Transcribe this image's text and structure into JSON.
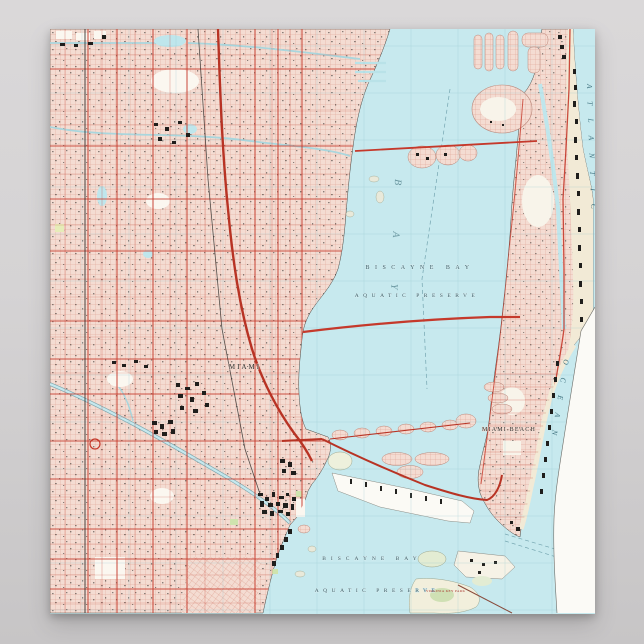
{
  "scene": {
    "background_top": "#d9d7d8",
    "background_bottom": "#c6c4c5"
  },
  "poster": {
    "labels": {
      "bay_name_center": "BISCAYNE BAY",
      "preserve_center": "AQUATIC PRESERVE",
      "bay_name_south": "BISCAYNE BAY",
      "preserve_south": "AQUATIC PRESERVE",
      "city_miami": "MIAMI",
      "city_miami_beach": "MIAMI BEACH",
      "ocean_part1": "ATLANTIC",
      "ocean_part2": "OCEAN",
      "bay_large_italic": "B A Y",
      "virginia_key_park": "VIRGINIA KEY PARK"
    },
    "colors": {
      "water": "#c7e9ee",
      "urban_tint": "#f4dcd2",
      "street_line": "#dc9f8f",
      "road_red": "#c5392b",
      "graticule_teal": "#8fc3cc",
      "paper_white": "#fbfaf6",
      "sand": "#f2ead6",
      "park_green": "#d9e6b9",
      "ink": "#23221f"
    }
  }
}
